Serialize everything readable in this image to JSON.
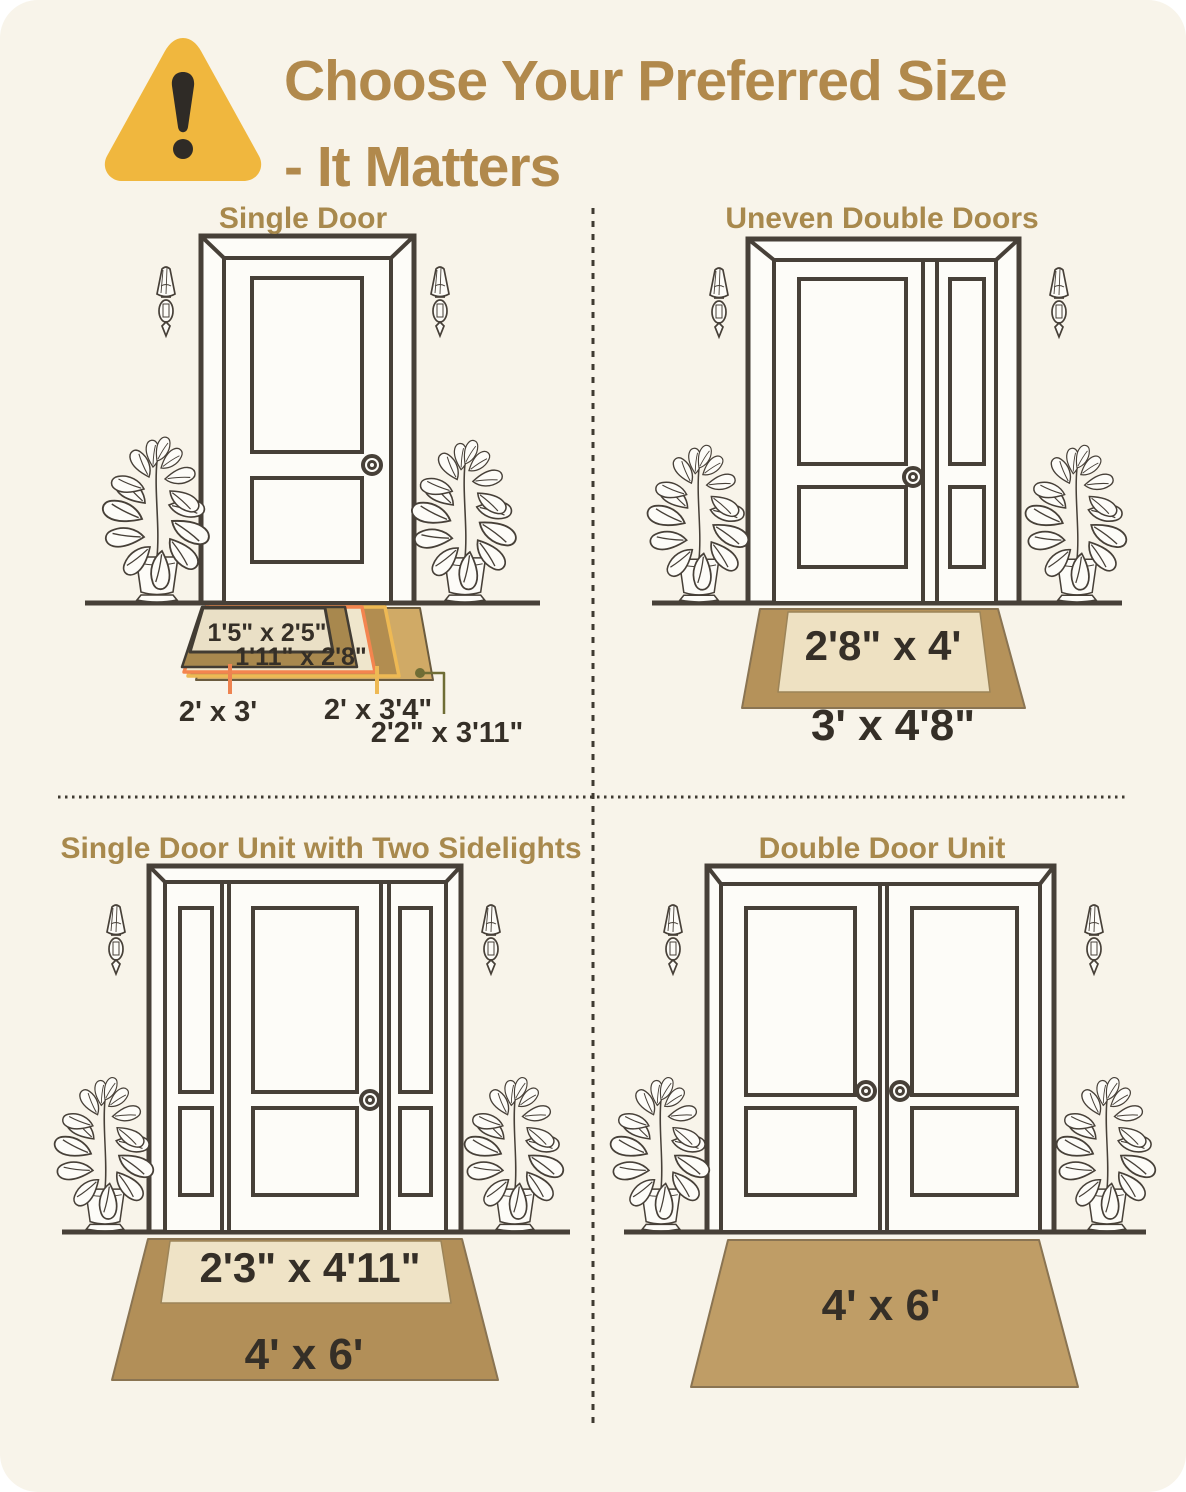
{
  "header": {
    "title_line1": "Choose Your Preferred Size",
    "title_line2": "- It Matters",
    "title_color": "#b1894c",
    "warning_icon_color": "#f0b73e"
  },
  "quadrants": [
    {
      "title": "Single Door",
      "mats": [
        {
          "label": "1'5\" x 2'5\"",
          "color": "#eae0c6"
        },
        {
          "label": "1'11\" x 2'8\"",
          "color": "#a8884e"
        },
        {
          "label": "2' x 3'",
          "color": "#efe6cc",
          "callout_color": "#ee8350"
        },
        {
          "label": "2' x 3'4\"",
          "color": "#b28d50",
          "callout_color": "#eeb954"
        },
        {
          "label": "2'2\" x 3'11\"",
          "color": "#d0aa66",
          "callout_color": "#6f6d35"
        }
      ]
    },
    {
      "title": "Uneven Double Doors",
      "mats": [
        {
          "label": "2'8\" x 4'",
          "color": "#eee1c2"
        },
        {
          "label": "3' x 4'8\"",
          "color": "#b5925a"
        }
      ]
    },
    {
      "title": "Single Door Unit with Two Sidelights",
      "mats": [
        {
          "label": "2'3\" x 4'11\"",
          "color": "#efe3c6"
        },
        {
          "label": "4' x 6'",
          "color": "#b28f58"
        }
      ]
    },
    {
      "title": "Double Door Unit",
      "mats": [
        {
          "label": "4' x 6'",
          "color": "#bf9d66"
        }
      ]
    }
  ],
  "styles": {
    "background": "#f8f4ea",
    "outline_color": "#474038",
    "section_title_color": "#a8894d",
    "label_text_color": "#352f27"
  }
}
